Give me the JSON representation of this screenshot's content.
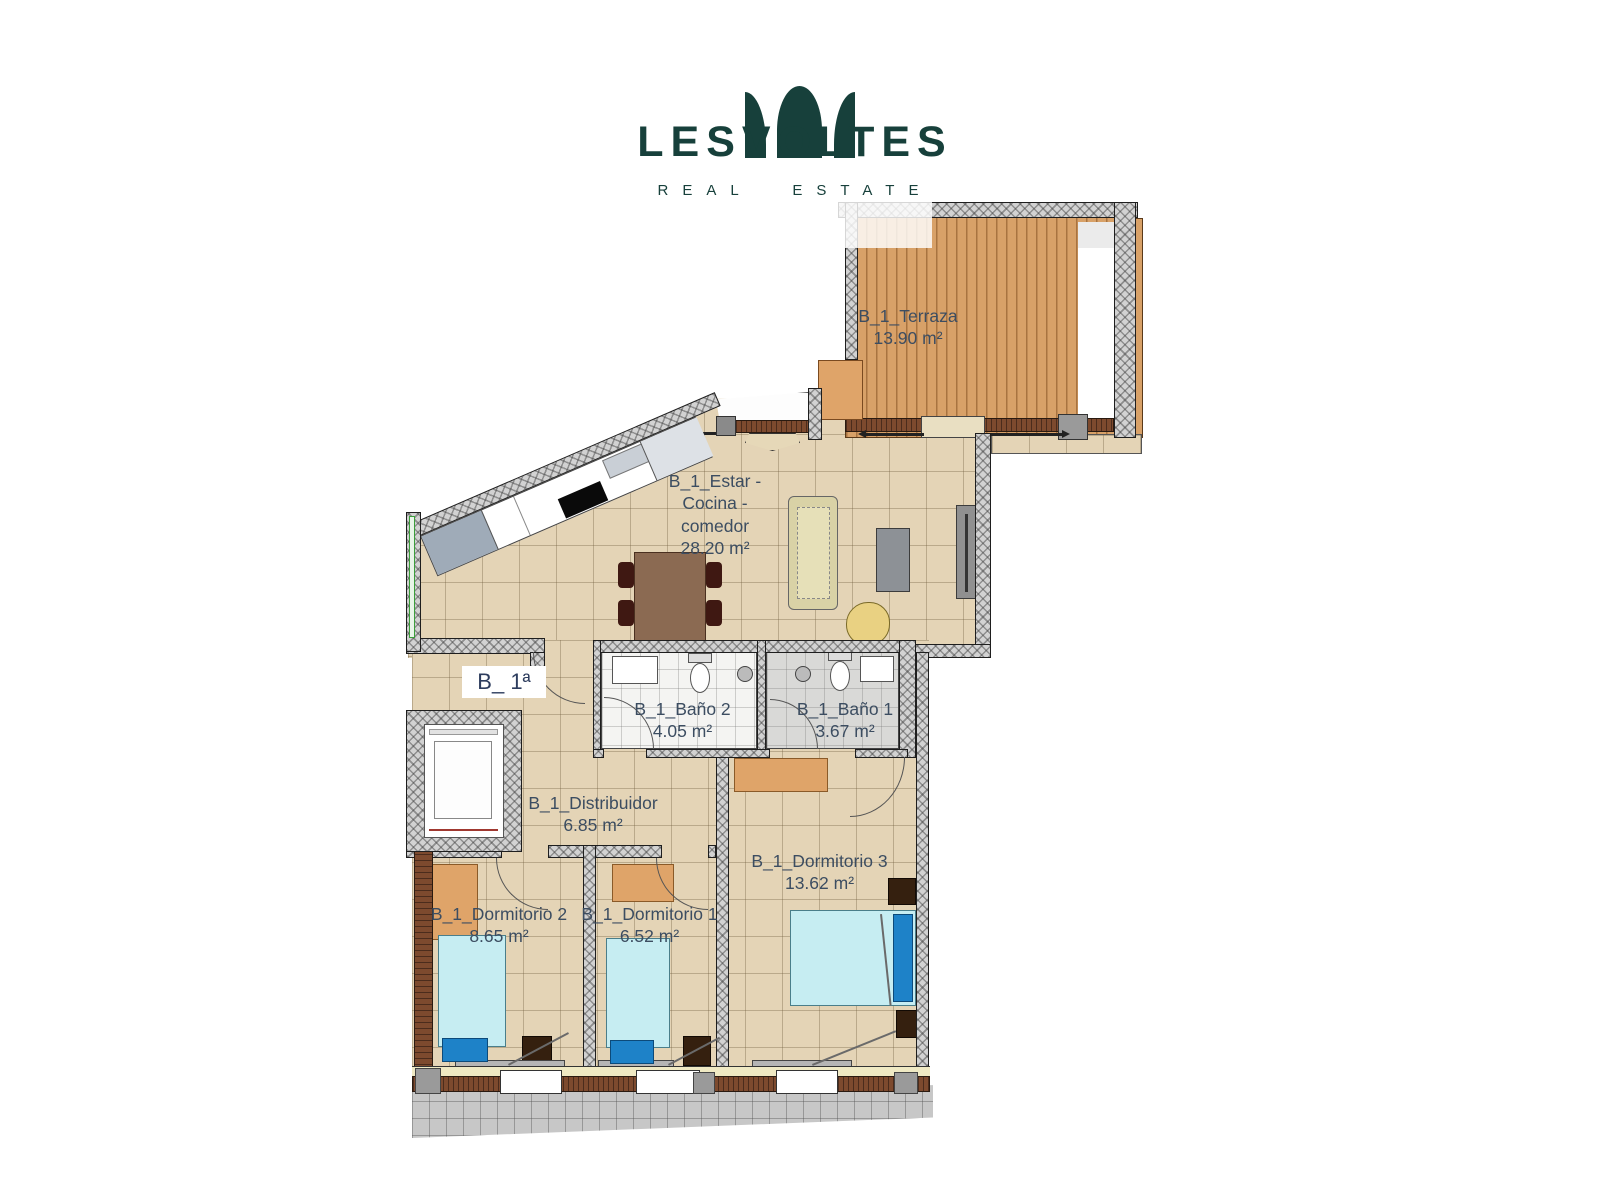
{
  "brand": {
    "name": "LESVOLTES",
    "tagline": "REAL ESTATE",
    "color": "#17403b"
  },
  "unit": {
    "label": "B_ 1ª"
  },
  "rooms": {
    "terraza": {
      "name": "B_1_Terraza",
      "area": "13.90 m²"
    },
    "estar": {
      "line1": "B_1_Estar -",
      "line2": "Cocina -",
      "line3": "comedor",
      "area": "28.20 m²"
    },
    "bano2": {
      "name": "B_1_Baño 2",
      "area": "4.05 m²"
    },
    "bano1": {
      "name": "B_1_Baño 1",
      "area": "3.67 m²"
    },
    "distribuidor": {
      "name": "B_1_Distribuidor",
      "area": "6.85 m²"
    },
    "dormitorio2": {
      "name": "B_1_Dormitorio 2",
      "area": "8.65 m²"
    },
    "dormitorio1": {
      "name": "B_1_Dormitorio 1",
      "area": "6.52 m²"
    },
    "dormitorio3": {
      "name": "B_1_Dormitorio 3",
      "area": "13.62 m²"
    }
  },
  "palette": {
    "brand_teal": "#17403b",
    "label_text": "#3c4d61",
    "unit_text": "#2e3d5e",
    "floor_tile": "#e4d4b6",
    "deck_wood": "#d8a168",
    "wall_gray": "#d2d2d2",
    "bed_cyan": "#c6edf2",
    "pillow_blue": "#1e82c8",
    "wardrobe_orange": "#dfa469"
  }
}
